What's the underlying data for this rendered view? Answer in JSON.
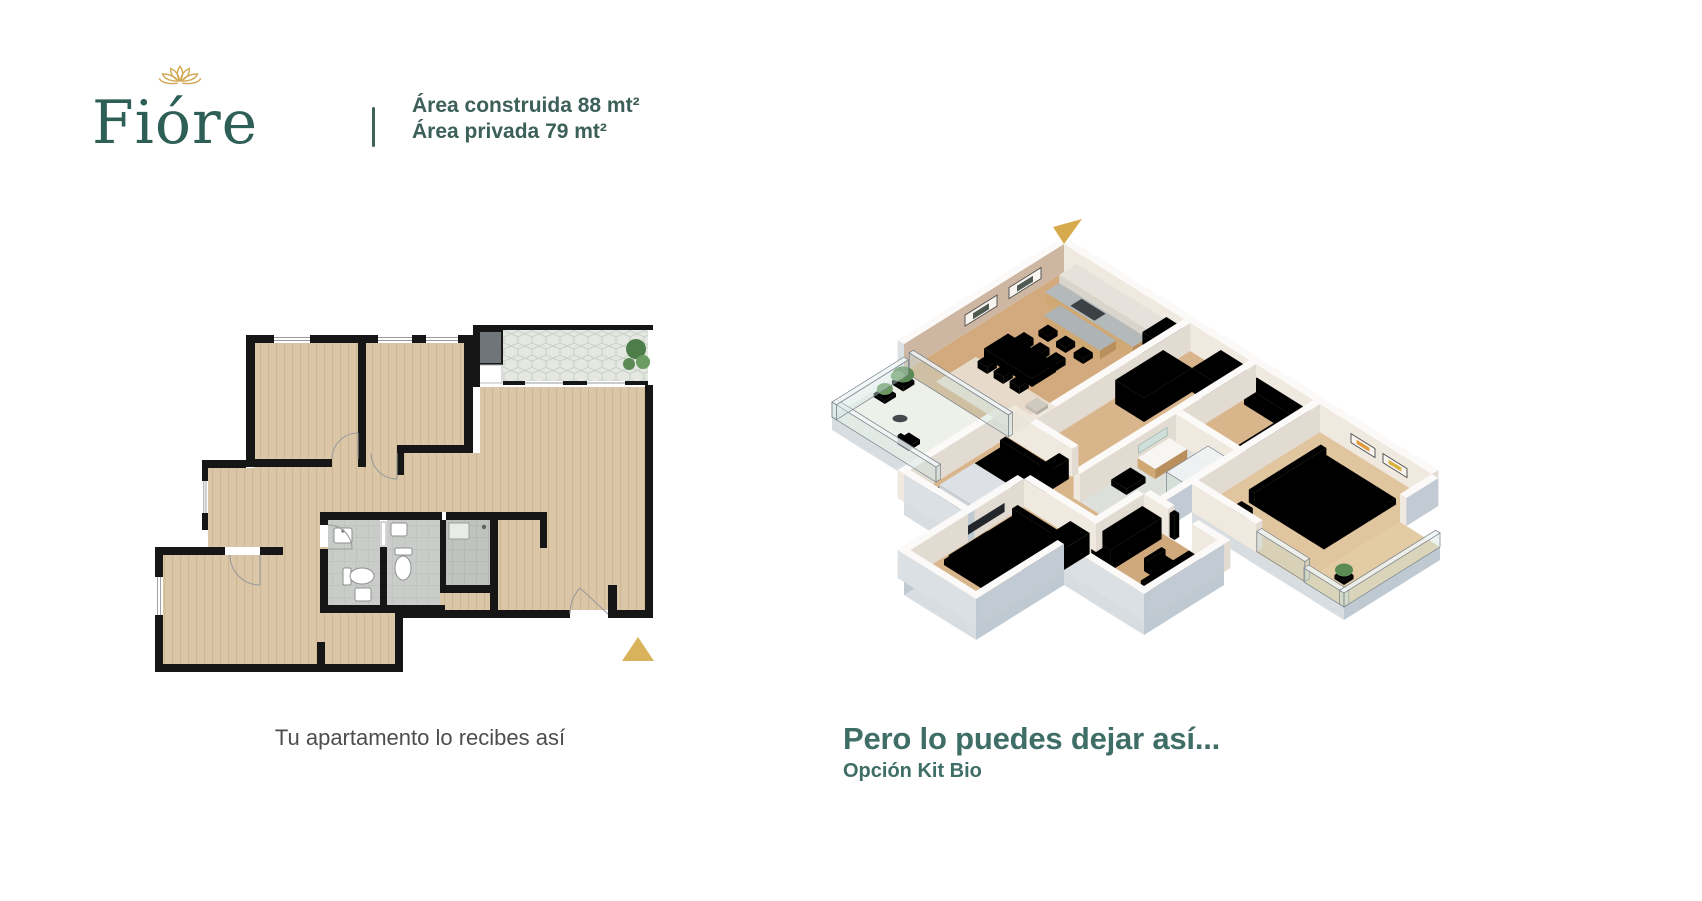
{
  "brand": {
    "name": "Fióre"
  },
  "header": {
    "area_built": "Área construida 88 mt²",
    "area_private": "Área privada 79 mt²"
  },
  "figures": {
    "plan2d": {
      "caption": "Tu apartamento lo recibes así"
    },
    "plan3d": {
      "title": "Pero lo puedes dejar así...",
      "subtitle": "Opción Kit Bio"
    }
  },
  "colors": {
    "brand_teal": "#2e5f56",
    "heading_teal": "#3f6e67",
    "accent_gold": "#d7ab55",
    "caption_gray": "#4d4d4d",
    "floor_wood": "#dbc7a8",
    "wall_black": "#161616"
  }
}
